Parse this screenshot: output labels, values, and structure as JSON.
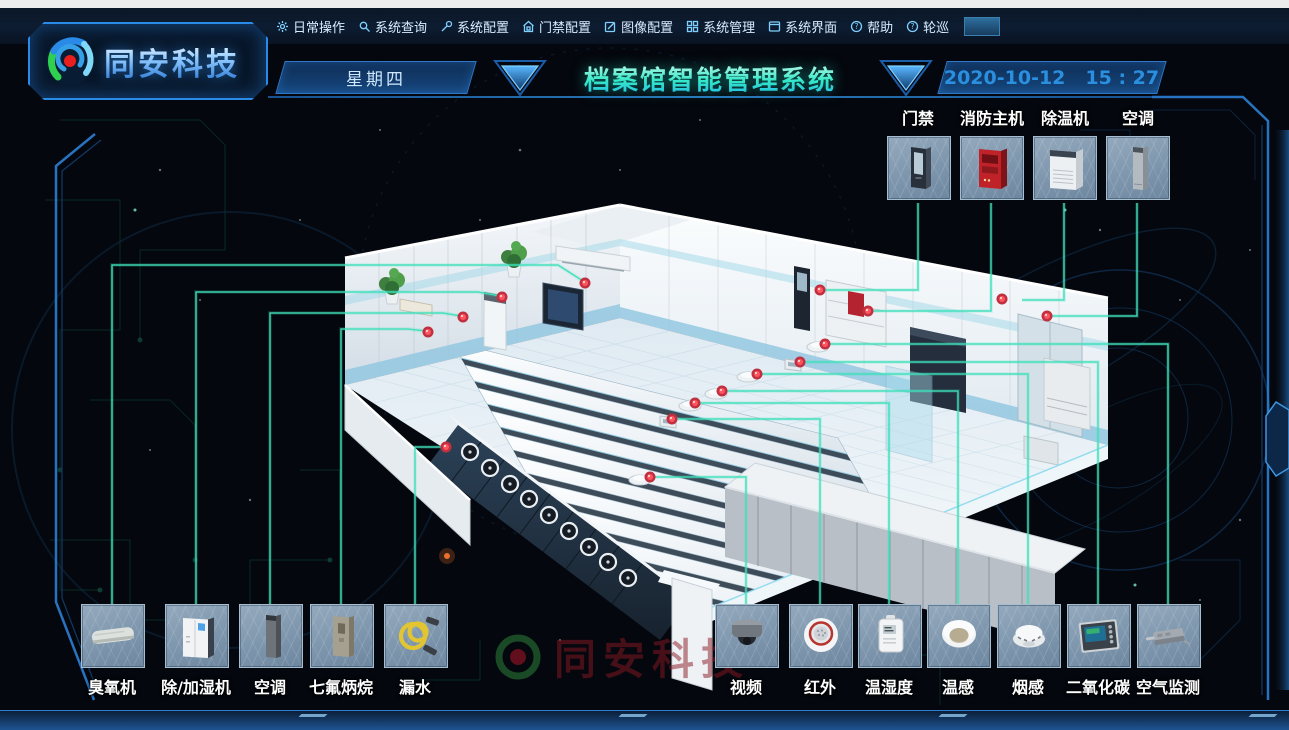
{
  "menu": {
    "items": [
      {
        "label": "日常操作",
        "icon": "gear"
      },
      {
        "label": "系统查询",
        "icon": "search"
      },
      {
        "label": "系统配置",
        "icon": "wrench"
      },
      {
        "label": "门禁配置",
        "icon": "home-lock"
      },
      {
        "label": "图像配置",
        "icon": "edit-pencil"
      },
      {
        "label": "系统管理",
        "icon": "grid"
      },
      {
        "label": "系统界面",
        "icon": "window"
      },
      {
        "label": "帮助",
        "icon": "help-circle"
      },
      {
        "label": "轮巡",
        "icon": "patrol-circle"
      }
    ],
    "blank_button_label": ""
  },
  "brand": {
    "logo_text": "同安科技"
  },
  "header": {
    "weekday": "星期四",
    "title": "档案馆智能管理系统",
    "date": "2020-10-12",
    "time": "15 : 27"
  },
  "watermark": {
    "text": "同安科技"
  },
  "device_groups": {
    "top_right": {
      "label_position": "above",
      "items": [
        {
          "label": "门禁",
          "icon": "access-terminal"
        },
        {
          "label": "消防主机",
          "icon": "fire-alarm-host"
        },
        {
          "label": "除温机",
          "icon": "dehumidifier-cabinet"
        },
        {
          "label": "空调",
          "icon": "ac-column-gray"
        }
      ]
    },
    "bottom_left": {
      "label_position": "below",
      "items": [
        {
          "label": "臭氧机",
          "icon": "ozone-unit"
        },
        {
          "label": "除/加湿机",
          "icon": "humidifier-cabinet"
        },
        {
          "label": "空调",
          "icon": "ac-column-dark"
        },
        {
          "label": "七氟炳烷",
          "icon": "hfc-extinguisher"
        },
        {
          "label": "漏水",
          "icon": "leak-cable"
        }
      ]
    },
    "bottom_right": {
      "label_position": "below",
      "items": [
        {
          "label": "视频",
          "icon": "dome-camera"
        },
        {
          "label": "红外",
          "icon": "infrared-detector"
        },
        {
          "label": "温湿度",
          "icon": "temp-humidity-sensor"
        },
        {
          "label": "温感",
          "icon": "heat-detector"
        },
        {
          "label": "烟感",
          "icon": "smoke-detector"
        },
        {
          "label": "二氧化碳",
          "icon": "co2-panel"
        },
        {
          "label": "空气监测",
          "icon": "air-quality-monitor"
        }
      ]
    }
  },
  "colors": {
    "accent_blue": "#2a8ae0",
    "connector_teal": "#3fe0bb",
    "marker_red": "#ff4a55",
    "title_cyan": "#35e8c8",
    "date_blue": "#2b8fe0"
  }
}
